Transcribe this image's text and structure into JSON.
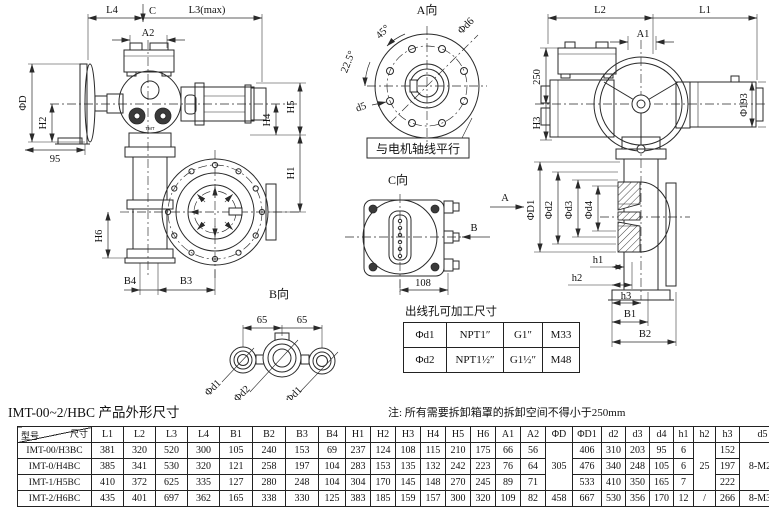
{
  "ink": "#1a1a1a",
  "drawing": {
    "left_view": {
      "L4": "L4",
      "C": "C",
      "L3": "L3(max)",
      "A2": "A2",
      "phiD": "ΦD",
      "H2": "H2",
      "dim95": "95",
      "H5": "H5",
      "H4": "H4",
      "H1": "H1",
      "H6": "H6",
      "B4": "B4",
      "B3": "B3",
      "logo": "TMT"
    },
    "a_view": {
      "title": "A向",
      "deg45": "45°",
      "deg22": "22.5°",
      "phid6": "Φd6",
      "d5": "d5",
      "note": "与电机轴线平行"
    },
    "right_view": {
      "L2": "L2",
      "L1": "L1",
      "A1": "A1",
      "dim250": "250",
      "H3": "H3",
      "phi193": "Φ193",
      "phiD1": "ΦD1",
      "phid2": "Φd2",
      "phid3": "Φd3",
      "phid4": "Φd4",
      "h1": "h1",
      "h2": "h2",
      "h3": "h3",
      "B1": "B1",
      "B2": "B2"
    },
    "c_view": {
      "title": "C向",
      "arrowA": "A",
      "arrowB": "B",
      "dim108": "108"
    },
    "b_view": {
      "title": "B向",
      "d65": [
        "65",
        "65"
      ],
      "phid1": [
        "Φd1",
        "Φd1"
      ],
      "phid2": "Φd2"
    }
  },
  "hole_table": {
    "title": "出线孔可加工尺寸",
    "rows": [
      [
        "Φd1",
        "NPT1″",
        "G1″",
        "M33"
      ],
      [
        "Φd2",
        "NPT1½″",
        "G1½″",
        "M48"
      ]
    ]
  },
  "caption": {
    "title": "IMT-00~2/HBC 产品外形尺寸",
    "note": "注: 所有需要拆卸箱罩的拆卸空间不得小于250mm"
  },
  "main_table": {
    "corner": {
      "top": "尺寸",
      "bottom": "型号"
    },
    "columns": [
      "L1",
      "L2",
      "L3",
      "L4",
      "B1",
      "B2",
      "B3",
      "B4",
      "H1",
      "H2",
      "H3",
      "H4",
      "H5",
      "H6",
      "A1",
      "A2",
      "ΦD",
      "ΦD1",
      "d2",
      "d3",
      "d4",
      "h1",
      "h2",
      "h3",
      "d5",
      "d6"
    ],
    "merged_columns": [
      16,
      22,
      24
    ],
    "rows": [
      {
        "model": "IMT-00/H3BC",
        "values": [
          "381",
          "320",
          "520",
          "300",
          "105",
          "240",
          "153",
          "69",
          "237",
          "124",
          "108",
          "115",
          "210",
          "175",
          "66",
          "56",
          "305",
          "406",
          "310",
          "203",
          "95",
          "6",
          "25",
          "152",
          "8-M20",
          "356"
        ]
      },
      {
        "model": "IMT-0/H4BC",
        "values": [
          "385",
          "341",
          "530",
          "320",
          "121",
          "258",
          "197",
          "104",
          "283",
          "153",
          "135",
          "132",
          "242",
          "223",
          "76",
          "64",
          "",
          "476",
          "340",
          "248",
          "105",
          "6",
          "",
          "197",
          "",
          "406"
        ]
      },
      {
        "model": "IMT-1/H5BC",
        "values": [
          "410",
          "372",
          "625",
          "335",
          "127",
          "280",
          "248",
          "104",
          "304",
          "170",
          "145",
          "148",
          "270",
          "245",
          "89",
          "71",
          "",
          "533",
          "410",
          "350",
          "165",
          "7",
          "",
          "222",
          "",
          "466"
        ]
      },
      {
        "model": "IMT-2/H6BC",
        "values": [
          "435",
          "401",
          "697",
          "362",
          "165",
          "338",
          "330",
          "125",
          "383",
          "185",
          "159",
          "157",
          "300",
          "320",
          "109",
          "82",
          "458",
          "667",
          "530",
          "356",
          "170",
          "12",
          "/",
          "266",
          "8-M30",
          "584"
        ]
      }
    ]
  }
}
